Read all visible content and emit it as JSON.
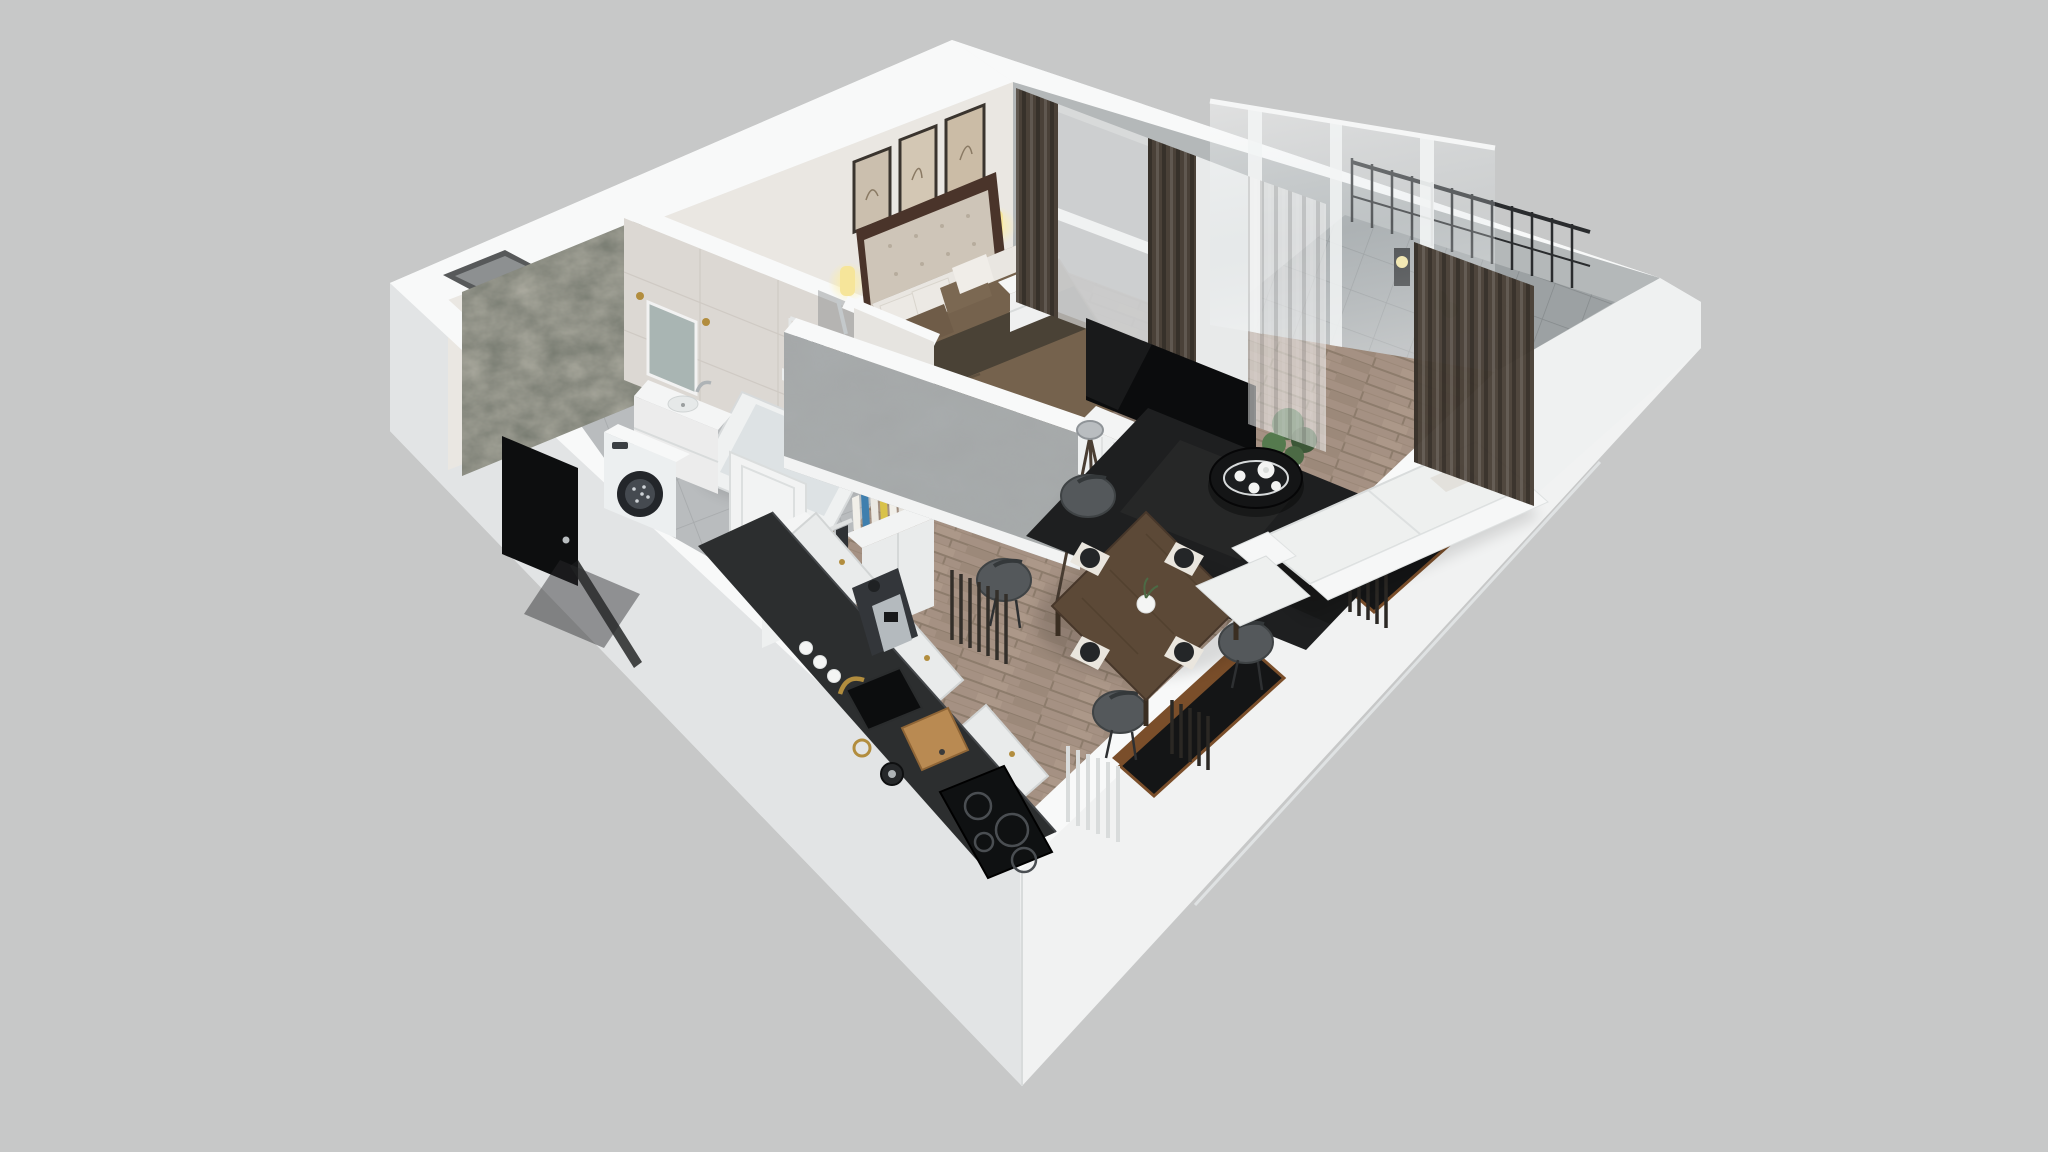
{
  "scene": {
    "kind": "isometric-3d-floor-plan-render",
    "view": "dollhouse cutaway from above",
    "background": "#c7c8c8"
  },
  "colors": {
    "background": "#c7c8c8",
    "wall_top": "#f8f9f9",
    "wall_inner": "#eae7e2",
    "wall_gray": "#b4b8b9",
    "facade_left": "#e2e4e5",
    "facade_right": "#f1f2f2",
    "floor_wood": "#a59183",
    "floor_wood_line": "#8d7c6c",
    "tile_bath": "#b9bcbe",
    "tile_line": "#a6a9ab",
    "tile_balcony": "#9ca1a3",
    "marble": "#74786e",
    "concrete": "#a8acad",
    "rug": "#1e1f20",
    "tv": "#0b0c0d",
    "console": "#f3f4f4",
    "table_wood": "#5c4937",
    "chair": "#54585b",
    "sofa": "#eef0ef",
    "counter": "#2c2e2f",
    "cabinet": "#e9ebeb",
    "curtain_dark": "#4a4138",
    "sheer": "#f0f0f0",
    "glass": "#8f9699",
    "gold": "#b28d3e",
    "glow": "#f6e59a",
    "plant": "#4c6a45",
    "bed_blanket": "#75624d",
    "bed_throw": "#4a4236",
    "headboard": "#cec5b8",
    "headboard_wood": "#4a342a",
    "pillow": "#ece9e4",
    "pillow_brown": "#6f5c48",
    "window_dark": "#141516",
    "window_wood": "#7a4e2a",
    "radiator_dark": "#332f2a",
    "door_black": "#0d0e0f",
    "appliance": "#eceff0",
    "board_wood": "#b98a52",
    "book_blue": "#3f7fae",
    "book_yellow": "#d9c24a"
  },
  "rooms": {
    "bathroom": {
      "name": "bathroom",
      "items": [
        "marble-accent-wall",
        "mirror",
        "vanity-sink",
        "washing-machine",
        "bathtub",
        "shower-glass"
      ]
    },
    "hallway": {
      "name": "hallway",
      "items": [
        "entry-door",
        "bathroom-door",
        "coat-rack",
        "bookshelf",
        "storage-cabinet"
      ]
    },
    "bedroom": {
      "name": "bedroom",
      "frame_count": 3,
      "sconce_count": 2,
      "items": [
        "double-bed",
        "tufted-headboard",
        "pillows",
        "wall-frames",
        "wall-sconces",
        "nightstand",
        "clothes-rack",
        "window-curtains"
      ]
    },
    "kitchen": {
      "name": "kitchen",
      "items": [
        "l-shaped-counter",
        "induction-cooktop",
        "sink-gold-faucet",
        "cutting-board",
        "kettle",
        "coffee-machine",
        "mugs",
        "cabinet-fronts",
        "tall-cabinet"
      ]
    },
    "living_dining": {
      "name": "living-dining",
      "chair_count": 4,
      "placemat_count": 4,
      "items": [
        "wall-tv",
        "media-console",
        "tripod-floor-lamp",
        "area-rug",
        "round-coffee-table",
        "tea-set",
        "dining-table",
        "dining-chairs",
        "sofa",
        "radiators",
        "facade-windows",
        "potted-plant",
        "curtains"
      ]
    },
    "balcony": {
      "name": "balcony",
      "items": [
        "glass-sliding-wall",
        "railing",
        "lantern",
        "plant",
        "tile-floor",
        "parapet"
      ]
    }
  }
}
